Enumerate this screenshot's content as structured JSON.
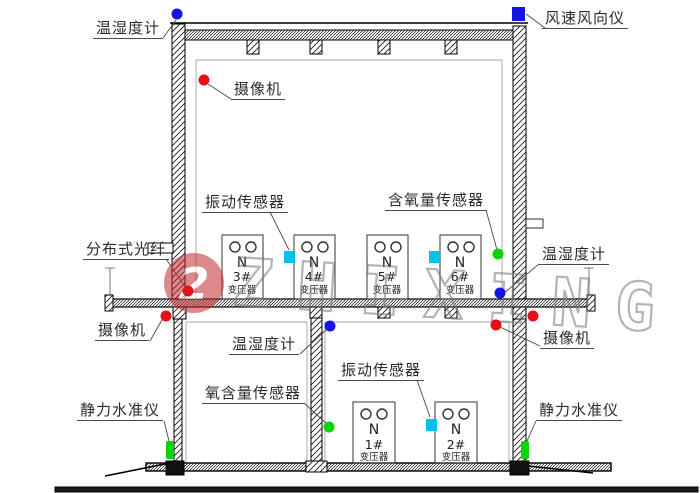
{
  "diagram_title": "transformer-substation-section-sensor-layout",
  "labels": {
    "temp_humidity_top_left": "温湿度计",
    "wind_speed_direction": "风速风向仪",
    "camera_top": "摄像机",
    "vibration_upper": "振动传感器",
    "oxygen_upper": "含氧量传感器",
    "distributed_fiber": "分布式光纤",
    "temp_humidity_upper_right": "温湿度计",
    "camera_mid_left": "摄像机",
    "camera_mid_right": "摄像机",
    "temp_humidity_lower": "温湿度计",
    "oxygen_lower": "氧含量传感器",
    "vibration_lower": "振动传感器",
    "static_level_left": "静力水准仪",
    "static_level_right": "静力水准仪"
  },
  "transformers": [
    {
      "letter": "N",
      "number": "3#",
      "name": "变压器"
    },
    {
      "letter": "N",
      "number": "4#",
      "name": "变压器"
    },
    {
      "letter": "N",
      "number": "5#",
      "name": "变压器"
    },
    {
      "letter": "N",
      "number": "6#",
      "name": "变压器"
    },
    {
      "letter": "N",
      "number": "1#",
      "name": "变压器"
    },
    {
      "letter": "N",
      "number": "2#",
      "name": "变压器"
    }
  ],
  "watermark": {
    "logo_digit": "2",
    "brand_text": "ZHIXING"
  },
  "colors": {
    "marker_blue": "#1414e6",
    "marker_cyan": "#00c0f0",
    "marker_green": "#0bd20b",
    "marker_red": "#e31219",
    "watermark_red": "#c3272e",
    "watermark_gray": "#8a8a8a",
    "line_black": "#000000"
  }
}
